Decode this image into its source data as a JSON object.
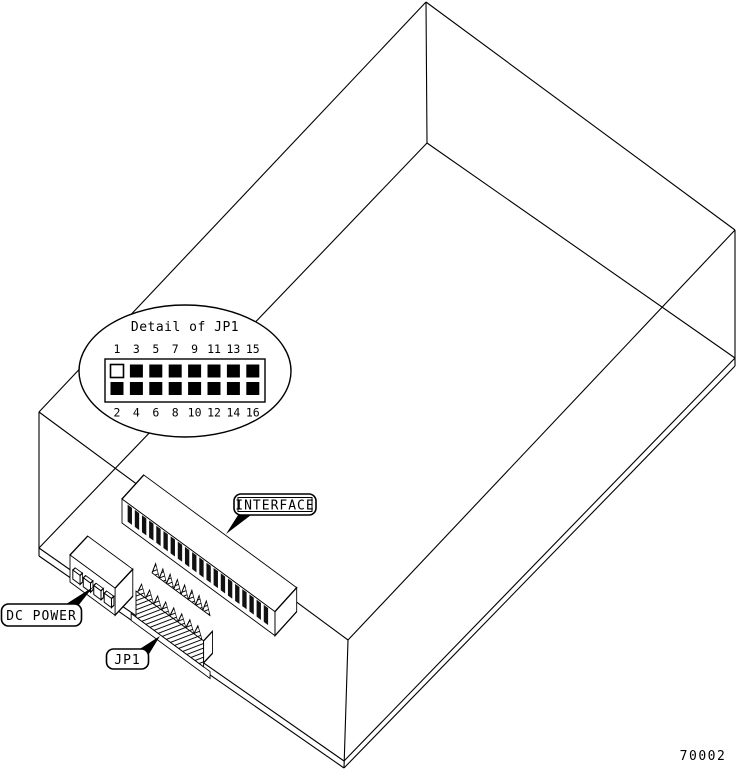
{
  "figure": {
    "number": "70002"
  },
  "detail_callout": {
    "title": "Detail of JP1",
    "rows": 2,
    "cols": 8,
    "open_pin": "1",
    "top_pin_numbers": [
      "1",
      "3",
      "5",
      "7",
      "9",
      "11",
      "13",
      "15"
    ],
    "bottom_pin_numbers": [
      "2",
      "4",
      "6",
      "8",
      "10",
      "12",
      "14",
      "16"
    ]
  },
  "component_labels": {
    "interface": "INTERFACE",
    "dc_power": "DC POWER",
    "jp1": "JP1"
  },
  "colors": {
    "line": "#000000",
    "background": "#ffffff",
    "pin_filled": "#000000",
    "pin_open": "#ffffff"
  }
}
